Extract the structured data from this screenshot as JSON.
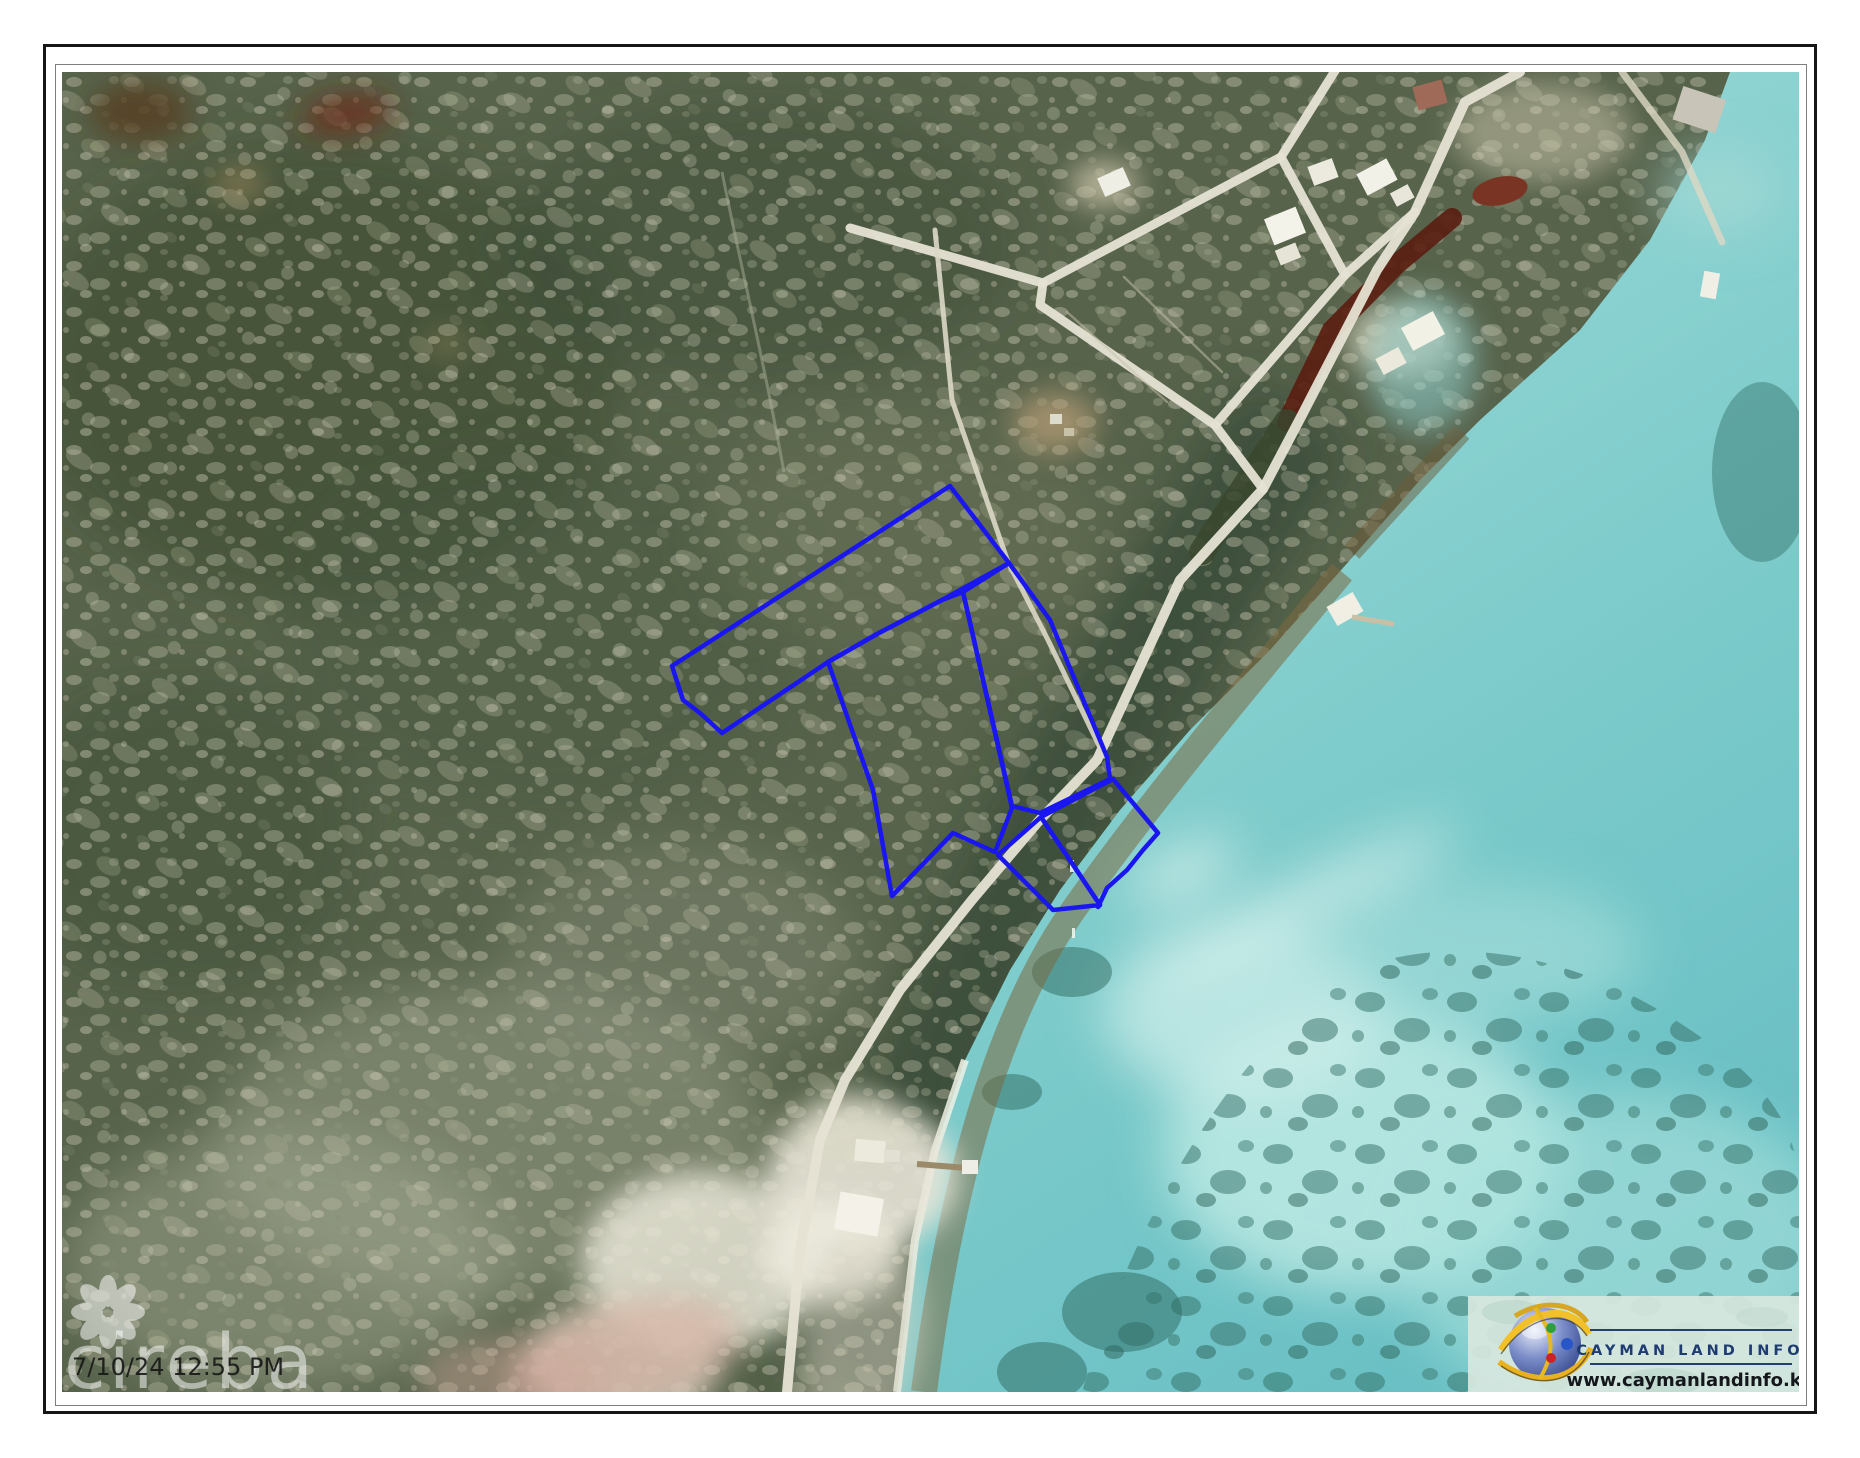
{
  "frame": {
    "outer_color": "#161616",
    "inner_color": "#7e7e7e"
  },
  "map": {
    "kind": "aerial-photograph",
    "scene": "coastal scrubland with subdivision roads, shoreline road and turquoise reef lagoon",
    "parcel_outline_color": "#1a16f0",
    "parcels": [
      {
        "id": "north-band-parcel",
        "points": "888,414 947,491 880,528 815,562 766,590 660,661 638,641 621,628 610,594"
      },
      {
        "id": "central-parcel",
        "points": "766,590 815,562 880,528 901,520 946,718 950,736 933,780 891,761 830,824 811,718"
      },
      {
        "id": "track-side-parcel",
        "points": "947,491 988,548 1045,685 1048,707 978,741 950,734 901,520"
      },
      {
        "id": "road-west-parcel",
        "points": "979,745 936,783 991,838 1038,833"
      },
      {
        "id": "road-east-parcel",
        "points": "979,745 1051,707 1096,761 1081,778 1065,798 1045,816 1036,835 1038,833"
      }
    ]
  },
  "watermark": {
    "brand": "cireba",
    "timestamp": "7/10/24 12:55 PM"
  },
  "logo": {
    "title": "CAYMAN LAND INFO",
    "website": "www.caymanlandinfo.ky",
    "title_color": "#1e3c72",
    "gold": "#e8b11d",
    "globe_blue": "#2c4090"
  }
}
